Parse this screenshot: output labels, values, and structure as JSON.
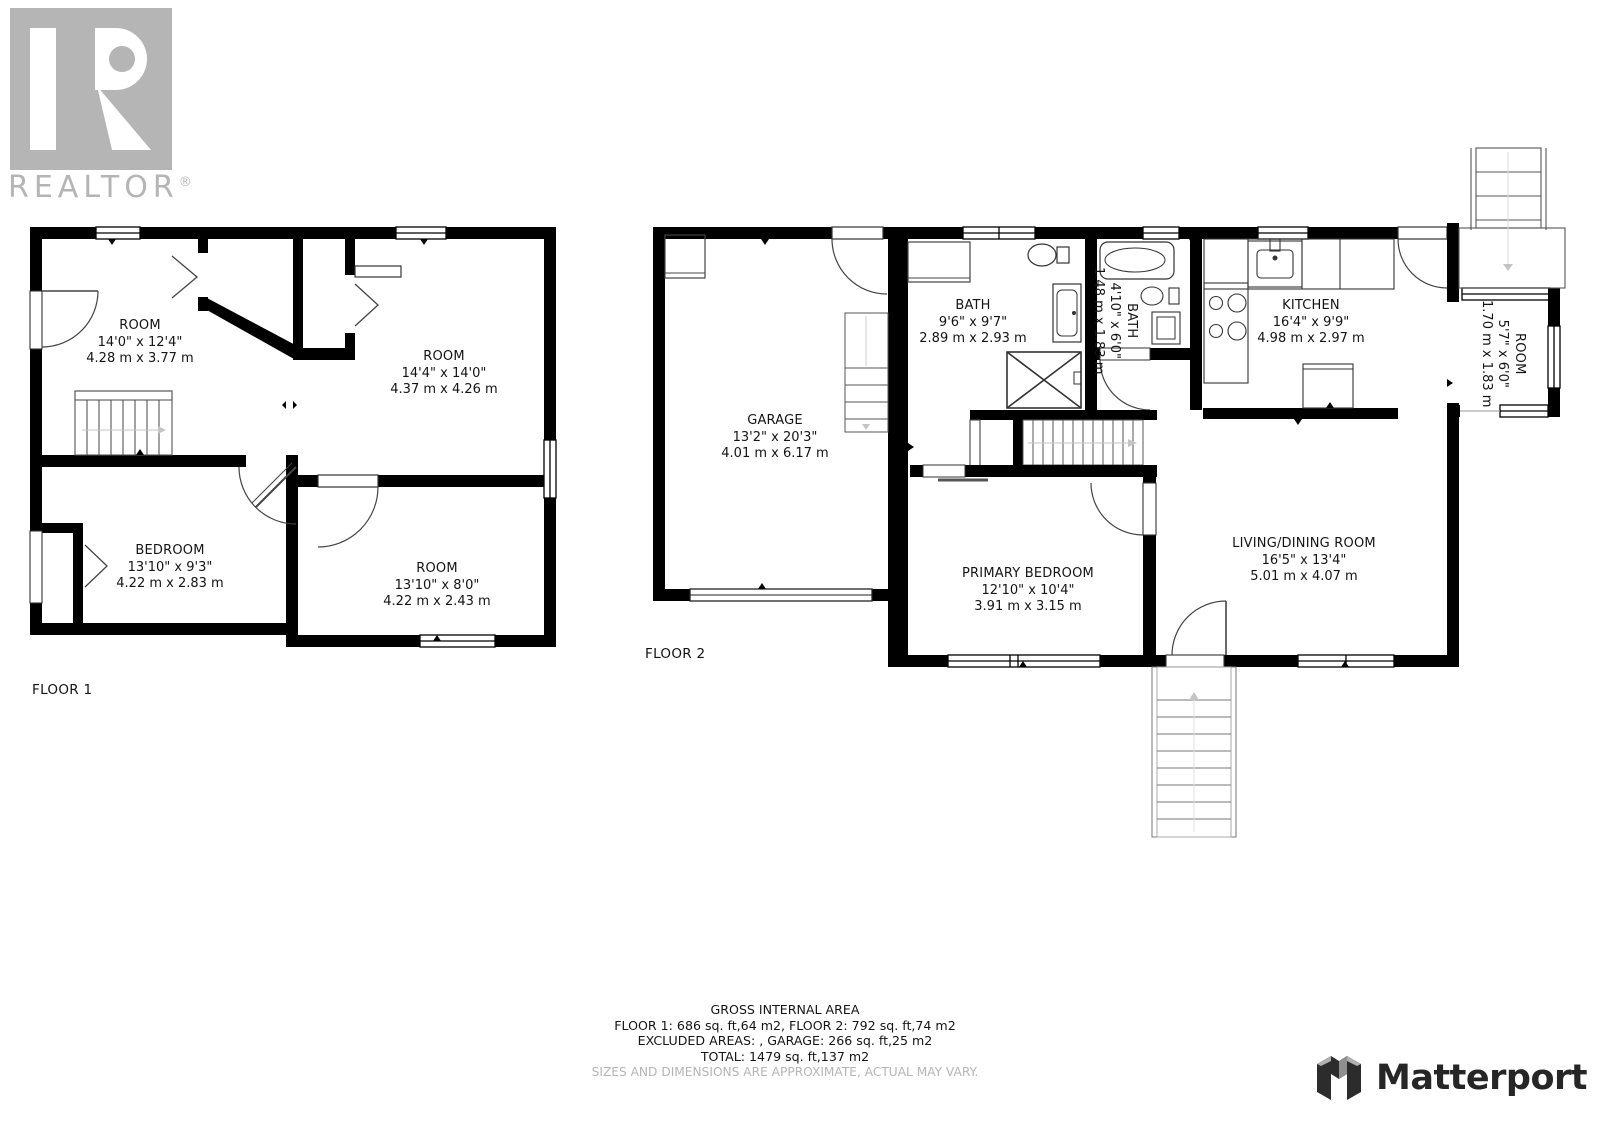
{
  "branding": {
    "realtor_wordmark": "REALTOR",
    "registered_mark": "®",
    "matterport_wordmark": "Matterport",
    "logo_gray": "#b5b5b5",
    "matterport_dark": "#262626",
    "wall_color": "#000000"
  },
  "floors": [
    {
      "label": "FLOOR 1",
      "rooms": [
        {
          "name": "ROOM",
          "imperial": "14'0\" x 12'4\"",
          "metric": "4.28 m x 3.77 m"
        },
        {
          "name": "ROOM",
          "imperial": "14'4\" x 14'0\"",
          "metric": "4.37 m x 4.26 m"
        },
        {
          "name": "BEDROOM",
          "imperial": "13'10\" x 9'3\"",
          "metric": "4.22 m x 2.83 m"
        },
        {
          "name": "ROOM",
          "imperial": "13'10\" x 8'0\"",
          "metric": "4.22 m x 2.43 m"
        }
      ]
    },
    {
      "label": "FLOOR 2",
      "rooms": [
        {
          "name": "GARAGE",
          "imperial": "13'2\" x 20'3\"",
          "metric": "4.01 m x 6.17 m"
        },
        {
          "name": "BATH",
          "imperial": "9'6\" x 9'7\"",
          "metric": "2.89 m x 2.93 m"
        },
        {
          "name": "BATH",
          "imperial": "4'10\" x 6'0\"",
          "metric": "1.48 m x 1.83 m",
          "rotated": true
        },
        {
          "name": "KITCHEN",
          "imperial": "16'4\" x 9'9\"",
          "metric": "4.98 m x 2.97 m"
        },
        {
          "name": "ROOM",
          "imperial": "5'7\" x 6'0\"",
          "metric": "1.70 m x 1.83 m",
          "rotated": true
        },
        {
          "name": "PRIMARY BEDROOM",
          "imperial": "12'10\" x 10'4\"",
          "metric": "3.91 m x 3.15 m"
        },
        {
          "name": "LIVING/DINING ROOM",
          "imperial": "16'5\" x 13'4\"",
          "metric": "5.01 m x 4.07 m"
        }
      ]
    }
  ],
  "summary": {
    "title": "GROSS INTERNAL AREA",
    "line1": "FLOOR 1: 686 sq. ft,64 m2, FLOOR 2: 792 sq. ft,74 m2",
    "line2": "EXCLUDED AREAS: , GARAGE: 266 sq. ft,25 m2",
    "line3": "TOTAL: 1479 sq. ft,137 m2",
    "disclaimer": "SIZES AND DIMENSIONS ARE APPROXIMATE, ACTUAL MAY VARY."
  }
}
